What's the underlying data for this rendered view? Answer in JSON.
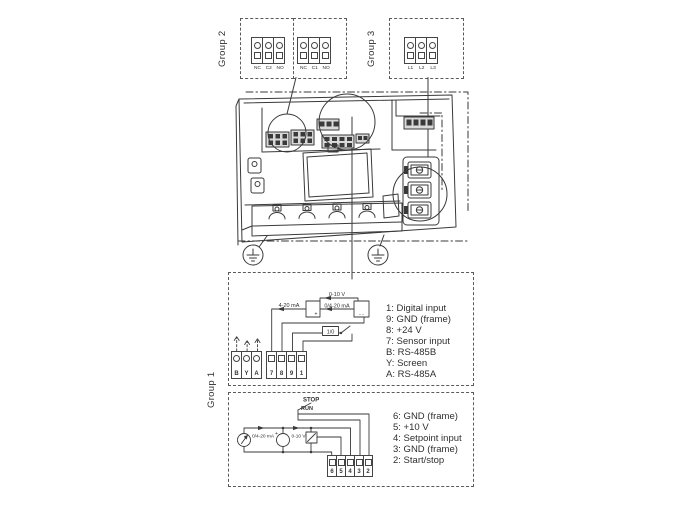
{
  "figure": {
    "background": "#ffffff",
    "line_color": "#3a3a3a",
    "text_color": "#2f2f2f"
  },
  "group2": {
    "label": "Group 2",
    "relay2_terminals": [
      "NC",
      "C2",
      "NO"
    ],
    "relay1_terminals": [
      "NC",
      "C1",
      "NO"
    ]
  },
  "group3": {
    "label": "Group 3",
    "power_terminals": [
      "L1",
      "L2",
      "L3"
    ]
  },
  "group1": {
    "label": "Group 1",
    "upper": {
      "bus_terminals": [
        "B",
        "Y",
        "A"
      ],
      "io_terminals": [
        "7",
        "8",
        "9",
        "1"
      ],
      "labels": {
        "voltage_range": "0-10 V",
        "current_range_left": "4-20 mA",
        "current_range_right": "0/4-20 mA",
        "switch": "1/0",
        "sensor_plus": "+",
        "sensor_minus": "- -"
      },
      "legend": [
        "1: Digital input",
        "9: GND (frame)",
        "8: +24 V",
        "7: Sensor input",
        "B: RS-485B",
        "Y: Screen",
        "A: RS-485A"
      ]
    },
    "lower": {
      "terminals": [
        "6",
        "5",
        "4",
        "3",
        "2"
      ],
      "labels": {
        "stop": "STOP",
        "run": "RUN",
        "current_source": "0/4-20 mA",
        "voltage_source": "0-10 V",
        "plus": "+"
      },
      "legend": [
        "6: GND (frame)",
        "5: +10 V",
        "4: Setpoint input",
        "3: GND (frame)",
        "2: Start/stop"
      ]
    }
  }
}
